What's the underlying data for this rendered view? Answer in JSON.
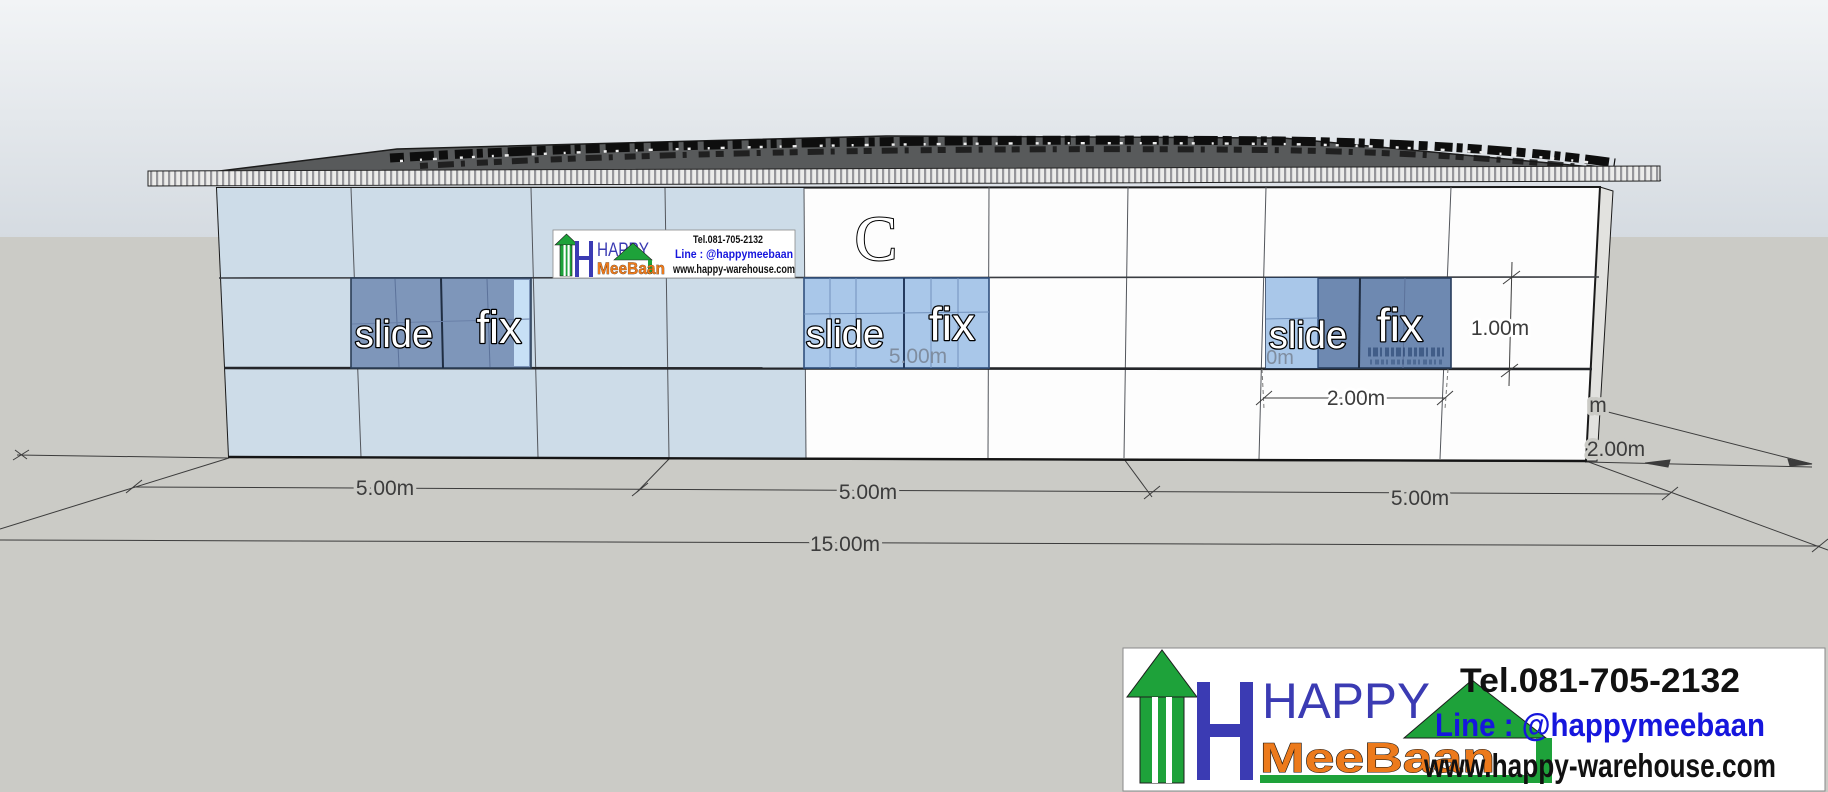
{
  "scene": {
    "sky_top": "#f2f4f6",
    "sky_bottom": "#d5dbe1",
    "ground": "#cbcbc6",
    "roof": "#585a5b",
    "wall_white": "#fdfdfd",
    "wall_blue": "#cddce8",
    "window_dark": "#7e96ba",
    "window_light": "#a9c7e9"
  },
  "building": {
    "panel_letter": "C",
    "windows": {
      "left": {
        "slide": "slide",
        "fix": "fix"
      },
      "middle": {
        "slide": "slide",
        "fix": "fix",
        "note": "5.00m"
      },
      "right": {
        "slide": "slide",
        "fix": "fix",
        "note": "0m"
      }
    }
  },
  "dimensions": {
    "bay1": "5.00m",
    "bay2": "5.00m",
    "bay3": "5.00m",
    "total": "15.00m",
    "window_width": "2.00m",
    "window_height": "1.00m",
    "side_partial": "m",
    "side_depth": "2.00m"
  },
  "branding": {
    "happy": "HAPPY",
    "meebaan": "MeeBaan",
    "tel": "Tel.081-705-2132",
    "line": "Line :  @happymeebaan",
    "web": "www.happy-warehouse.com",
    "colors": {
      "green": "#1ea23a",
      "blue": "#3b3bb3",
      "orange": "#ec7a1c",
      "line_blue": "#1616dd",
      "black": "#111111"
    }
  }
}
